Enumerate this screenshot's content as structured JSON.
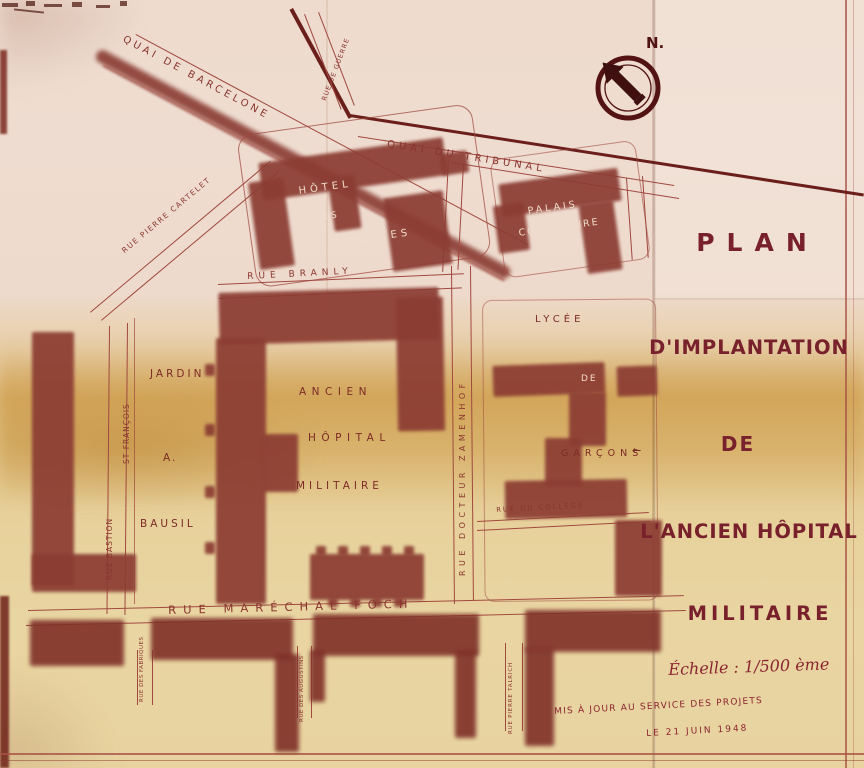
{
  "colors": {
    "ink": "#8a352e",
    "ink_dark": "#6b1f1a",
    "title_ink": "#78202c",
    "paper_top": "#eedbce",
    "paper_bottom": "#e8d3a0",
    "stain_amber": "#ddb876"
  },
  "compass": {
    "label": "N."
  },
  "streets": {
    "quai_de_barcelone": "QUAI DE BARCELONE",
    "quai_du_tribunal": "QUAI DU TRIBUNAL",
    "rue_de_guerre": "RUE DE GUERRE",
    "rue_pierre_cartelet": "RUE PIERRE CARTELET",
    "rue_branly": "RUE BRANLY",
    "rue_bastion": "RUE BASTION",
    "st_francois": "ST FRANÇOIS",
    "rue_docteur_zamenhof": "RUE DOCTEUR ZAMENHOF",
    "rue_marechal_foch": "RUE MARÉCHAL FOCH",
    "rue_du_college": "RUE DU COLLÈGE",
    "rue_des_fabriques": "RUE DES FABRIQUES",
    "rue_des_augustins": "RUE DES AUGUSTINS",
    "rue_pierre_talrich": "RUE PIERRE TALRICH"
  },
  "buildings": {
    "hotel_des_postes": {
      "line1": "HÔTEL",
      "line2": "DES",
      "line3": "POSTES"
    },
    "palais_consulaire": {
      "line1": "PALAIS",
      "line2": "CONSULAIRE"
    },
    "lycee": {
      "line1": "LYCÉE",
      "line2": "DE",
      "line3": "GARÇONS"
    },
    "hopital": {
      "line1": "ANCIEN",
      "line2": "HÔPITAL",
      "line3": "MILITAIRE"
    },
    "jardin": {
      "line1": "JARDIN",
      "line2": "A.",
      "line3": "BAUSIL"
    }
  },
  "title_block": {
    "line1": "PLAN",
    "line2": "D'IMPLANTATION",
    "line3": "DE",
    "line4": "L'ANCIEN HÔPITAL",
    "line5": "MILITAIRE",
    "scale": "Échelle : 1/500 ème",
    "note_line1": "MIS À JOUR AU SERVICE DES PROJETS",
    "note_line2": "LE 21 JUIN 1948"
  }
}
